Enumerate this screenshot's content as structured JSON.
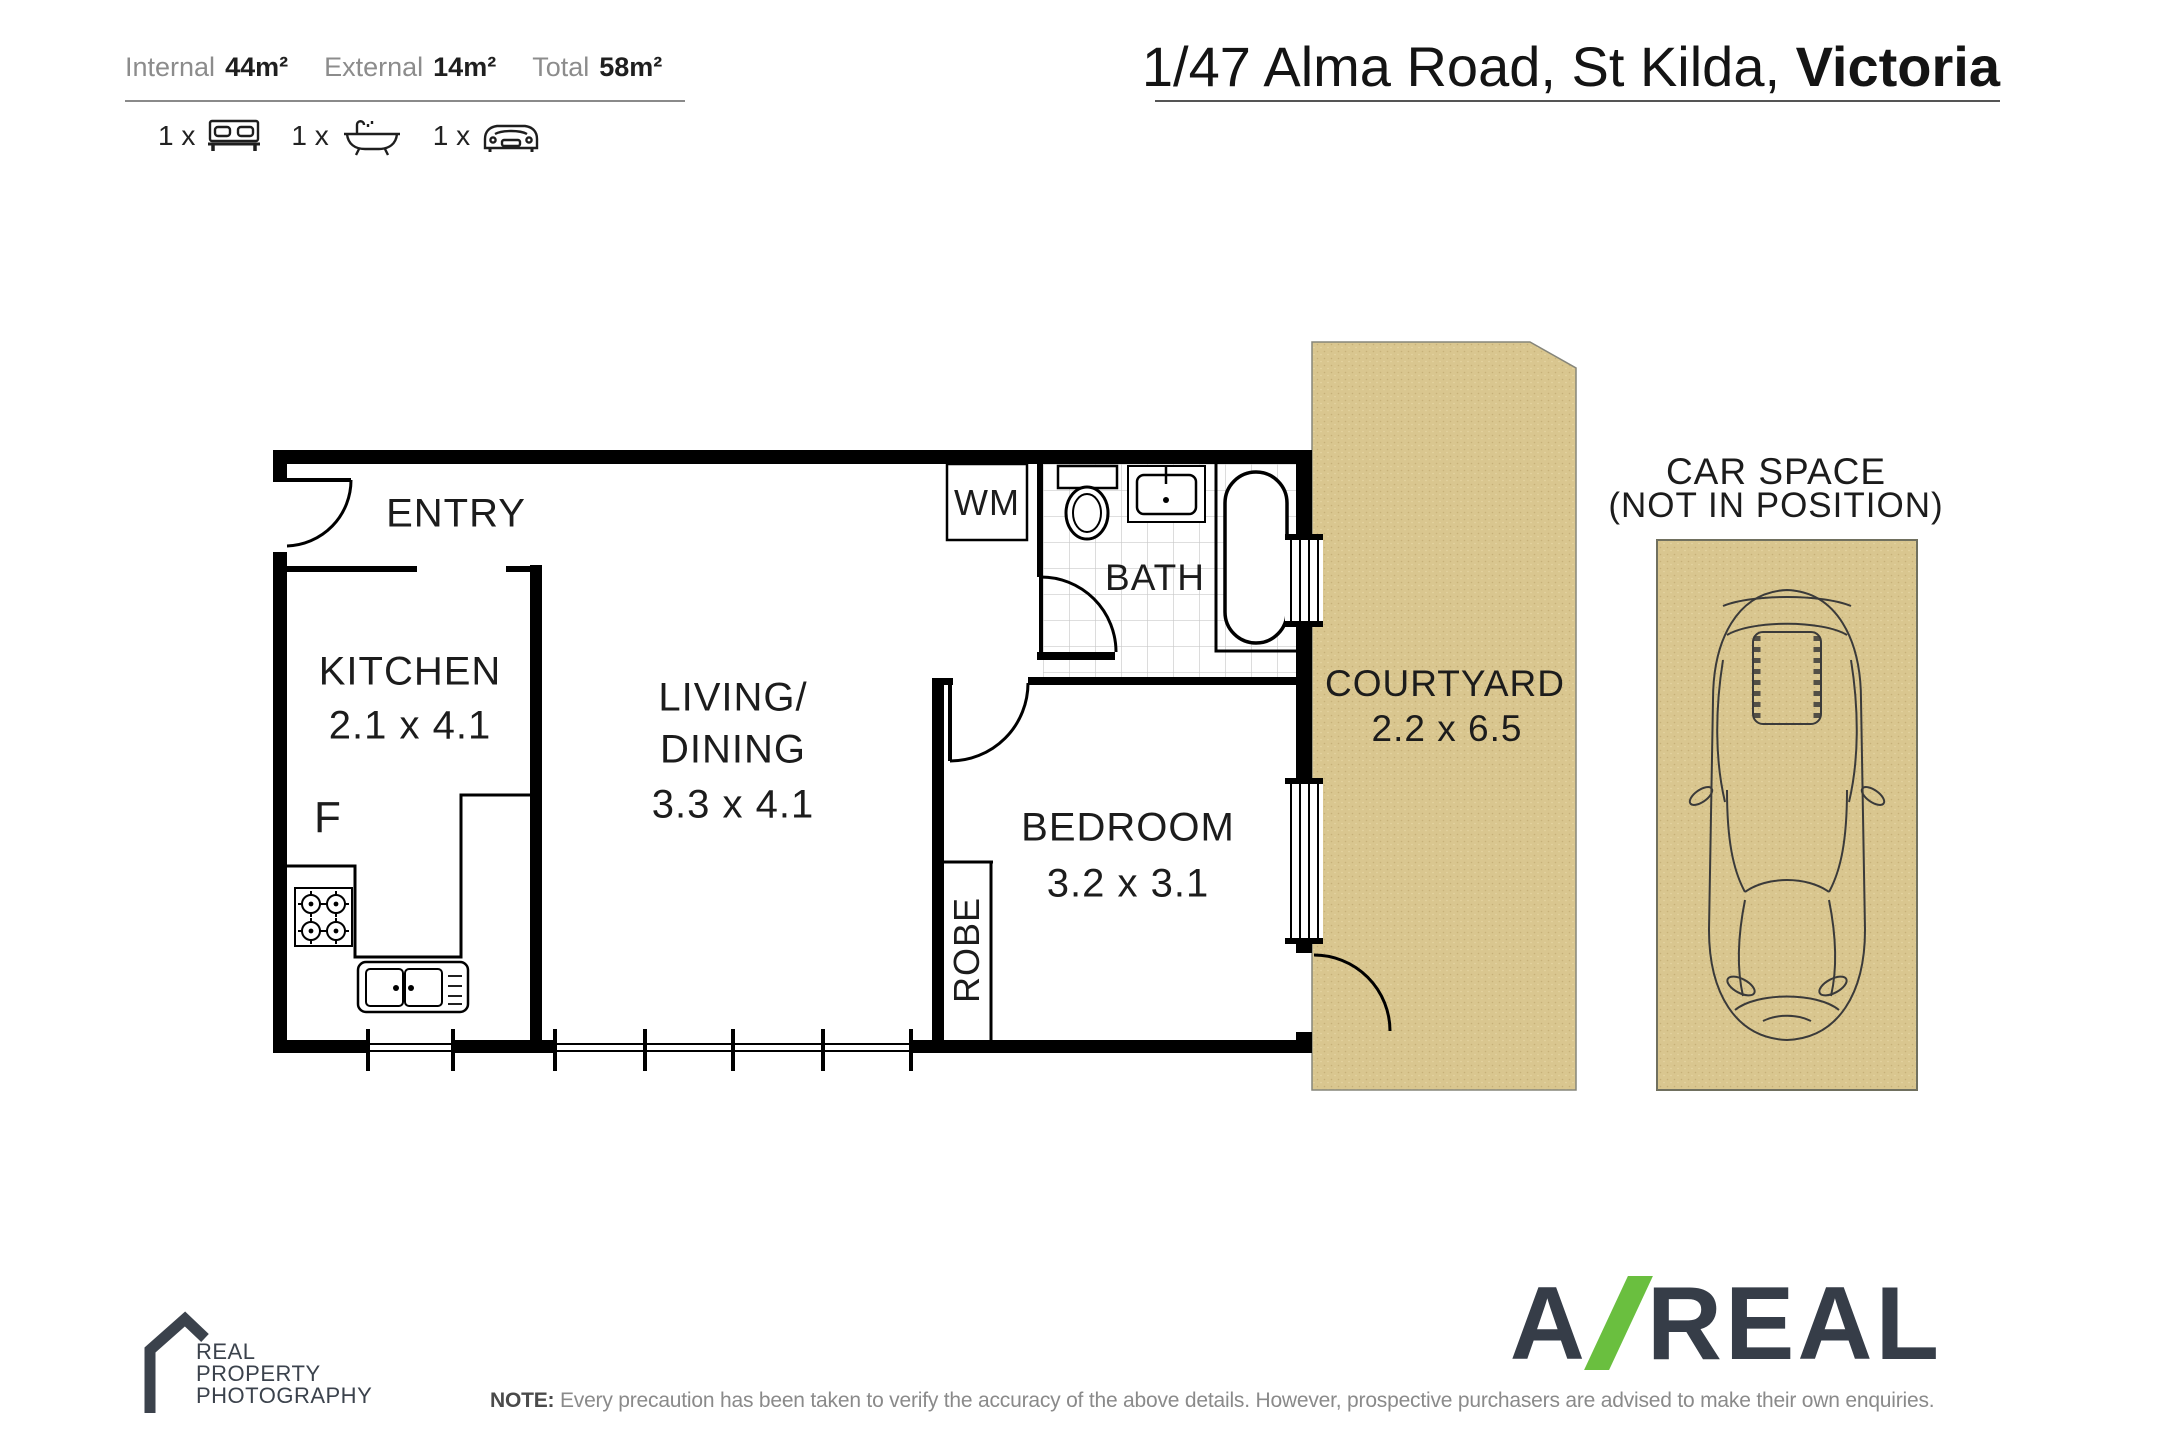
{
  "header": {
    "areas": [
      {
        "label": "Internal",
        "value": "44m²"
      },
      {
        "label": "External",
        "value": "14m²"
      },
      {
        "label": "Total",
        "value": "58m²"
      }
    ],
    "features": [
      {
        "count": "1 x",
        "icon": "bed-icon"
      },
      {
        "count": "1 x",
        "icon": "bath-icon"
      },
      {
        "count": "1 x",
        "icon": "car-icon"
      }
    ],
    "address_regular": "1/47 Alma Road, St Kilda, ",
    "address_bold": "Victoria"
  },
  "floorplan": {
    "labels": {
      "entry": "ENTRY",
      "kitchen": "KITCHEN",
      "kitchen_dims": "2.1 x 4.1",
      "fridge": "F",
      "living_line1": "LIVING/",
      "living_line2": "DINING",
      "living_dims": "3.3 x 4.1",
      "wm": "WM",
      "bath": "BATH",
      "bedroom": "BEDROOM",
      "bedroom_dims": "3.2 x 3.1",
      "robe": "ROBE",
      "courtyard": "COURTYARD",
      "courtyard_dims": "2.2 x 6.5",
      "carspace_line1": "CAR SPACE",
      "carspace_line2": "(NOT IN POSITION)"
    }
  },
  "footer": {
    "photographer_line1": "REAL",
    "photographer_line2": "PROPERTY",
    "photographer_line3": "PHOTOGRAPHY",
    "brand_letter": "A",
    "brand_rest": "REAL",
    "note_label": "NOTE:",
    "note_text": " Every precaution has been taken to verify the accuracy of the above details. However, prospective purchasers are advised to make their own enquiries."
  },
  "colors": {
    "courtyard": "#d9c68f",
    "logo_dark": "#363d48",
    "logo_green": "#6abf3f",
    "wall": "#000000"
  }
}
